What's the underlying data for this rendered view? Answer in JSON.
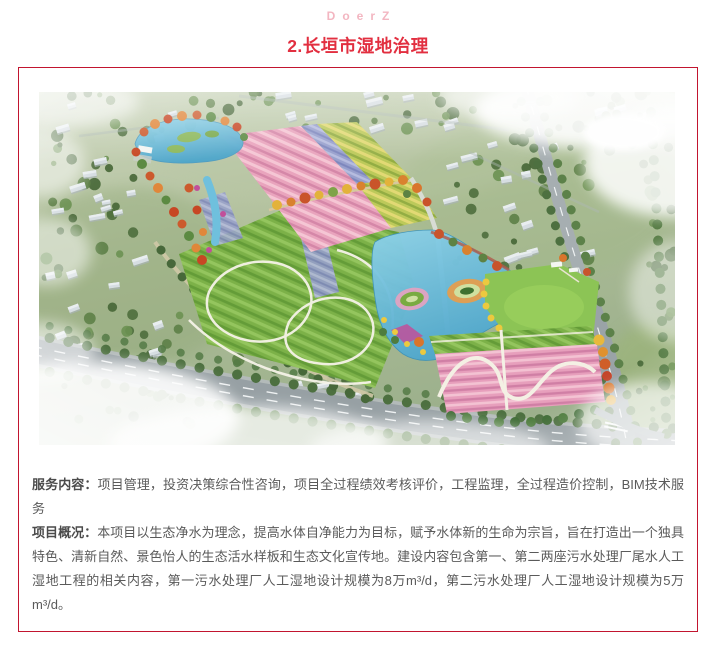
{
  "header": {
    "brand": "DoerZ",
    "title": "2.长垣市湿地治理"
  },
  "card": {
    "illustration": "wetland-park-aerial-rendering",
    "paragraphs": [
      {
        "label": "服务内容：",
        "text": "项目管理，投资决策综合性咨询，项目全过程绩效考核评价，工程监理，全过程造价控制，BIM技术服务"
      },
      {
        "label": "项目概况：",
        "text": "本项目以生态净水为理念，提高水体自净能力为目标，赋予水体新的生命为宗旨，旨在打造出一个独具特色、清新自然、景色怡人的生态活水样板和生态文化宣传地。建设内容包含第一、第二两座污水处理厂尾水人工湿地工程的相关内容，第一污水处理厂人工湿地设计规模为8万m³/d，第二污水处理厂人工湿地设计规模为5万m³/d。"
      }
    ]
  },
  "colors": {
    "brand_pink": "#f3b6c1",
    "title_red": "#e22f40",
    "card_border_red": "#c2152f",
    "body_text_gray": "#5a5a5a"
  }
}
